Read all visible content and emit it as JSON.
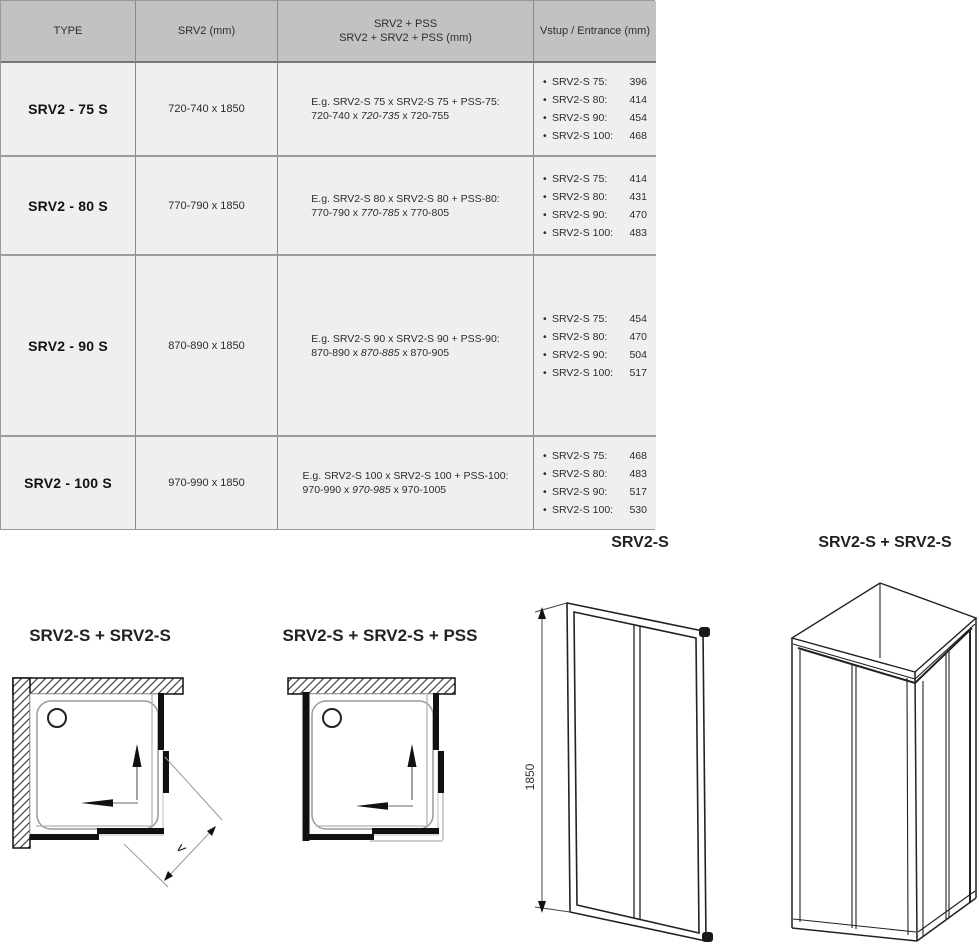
{
  "colors": {
    "header_bg": "#c2c2c2",
    "row_bg": "#efefef",
    "grid_line": "#8a8a8a"
  },
  "table": {
    "bullet": "•",
    "header": {
      "c1": "TYPE",
      "c2": "SRV2 (mm)",
      "c3_line1": "SRV2 + PSS",
      "c3_line2": "SRV2 + SRV2 + PSS (mm)",
      "c4": "Vstup / Entrance (mm)"
    },
    "rows": [
      {
        "type": "SRV2 - 75 S",
        "size": "720-740 x 1850",
        "example_line1": "E.g. SRV2-S 75 x SRV2-S 75 + PSS-75:",
        "example_pre": "720-740 x ",
        "example_italic": "720-735",
        "example_post": " x 720-755",
        "entrance": [
          {
            "label": "SRV2-S 75:",
            "value": "396"
          },
          {
            "label": "SRV2-S 80:",
            "value": "414"
          },
          {
            "label": "SRV2-S 90:",
            "value": "454"
          },
          {
            "label": "SRV2-S 100:",
            "value": "468"
          }
        ]
      },
      {
        "type": "SRV2 - 80 S",
        "size": "770-790 x 1850",
        "example_line1": "E.g. SRV2-S 80 x SRV2-S 80 + PSS-80:",
        "example_pre": "770-790 x ",
        "example_italic": "770-785",
        "example_post": " x 770-805",
        "entrance": [
          {
            "label": "SRV2-S 75:",
            "value": "414"
          },
          {
            "label": "SRV2-S 80:",
            "value": "431"
          },
          {
            "label": "SRV2-S 90:",
            "value": "470"
          },
          {
            "label": "SRV2-S 100:",
            "value": "483"
          }
        ]
      },
      {
        "type": "SRV2 - 90 S",
        "size": "870-890 x 1850",
        "example_line1": "E.g. SRV2-S 90 x SRV2-S 90 + PSS-90:",
        "example_pre": "870-890 x ",
        "example_italic": "870-885",
        "example_post": " x 870-905",
        "entrance": [
          {
            "label": "SRV2-S 75:",
            "value": "454"
          },
          {
            "label": "SRV2-S 80:",
            "value": "470"
          },
          {
            "label": "SRV2-S 90:",
            "value": "504"
          },
          {
            "label": "SRV2-S 100:",
            "value": "517"
          }
        ]
      },
      {
        "type": "SRV2 - 100 S",
        "size": "970-990 x 1850",
        "example_line1": "E.g. SRV2-S 100 x SRV2-S 100 + PSS-100:",
        "example_pre": "970-990 x ",
        "example_italic": "970-985",
        "example_post": " x 970-1005",
        "entrance": [
          {
            "label": "SRV2-S 75:",
            "value": "468"
          },
          {
            "label": "SRV2-S 80:",
            "value": "483"
          },
          {
            "label": "SRV2-S 90:",
            "value": "517"
          },
          {
            "label": "SRV2-S 100:",
            "value": "530"
          }
        ]
      }
    ]
  },
  "diagrams": {
    "front": {
      "title": "SRV2-S",
      "height_label": "1850"
    },
    "corner3d": {
      "title": "SRV2-S + SRV2-S"
    },
    "plan_double": {
      "title": "SRV2-S + SRV2-S",
      "entrance_label": "v"
    },
    "plan_pss": {
      "title": "SRV2-S + SRV2-S + PSS"
    }
  }
}
